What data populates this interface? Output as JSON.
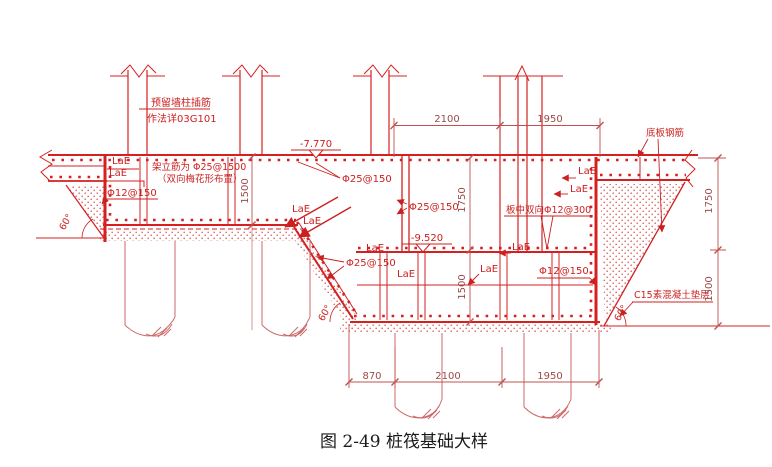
{
  "drawing": {
    "caption": "图 2-49 桩筏基础大样",
    "notes": {
      "reserved1": "预留墙柱插筋",
      "reserved2": "作法详03G101",
      "stand1": "架立筋为 Φ25@1500",
      "stand2": "（双向梅花形布置）",
      "mid_slab": "板中双向Φ12@300",
      "bottom_rebar": "底板钢筋",
      "bedding": "C15素混凝土垫层"
    },
    "rebar": {
      "lae": "LaE",
      "d25_150": "Φ25@150",
      "d12_150": "Φ12@150"
    },
    "elevations": {
      "upper": "-7.770",
      "lower": "-9.520"
    },
    "dims": {
      "top": [
        "2100",
        "1950"
      ],
      "bottom": [
        "870",
        "2100",
        "1950"
      ],
      "right_upper": "1750",
      "right_lower": "1500",
      "mid_upper": "1750",
      "mid_lower": "1500",
      "left_thickness": "1500"
    },
    "angle": "60°",
    "colors": {
      "line": "#d42020",
      "text": "#cc2020",
      "dim": "#c0504d",
      "pile": "#cd6a6a",
      "caption": "#1a1a1a",
      "background": "#ffffff"
    }
  }
}
